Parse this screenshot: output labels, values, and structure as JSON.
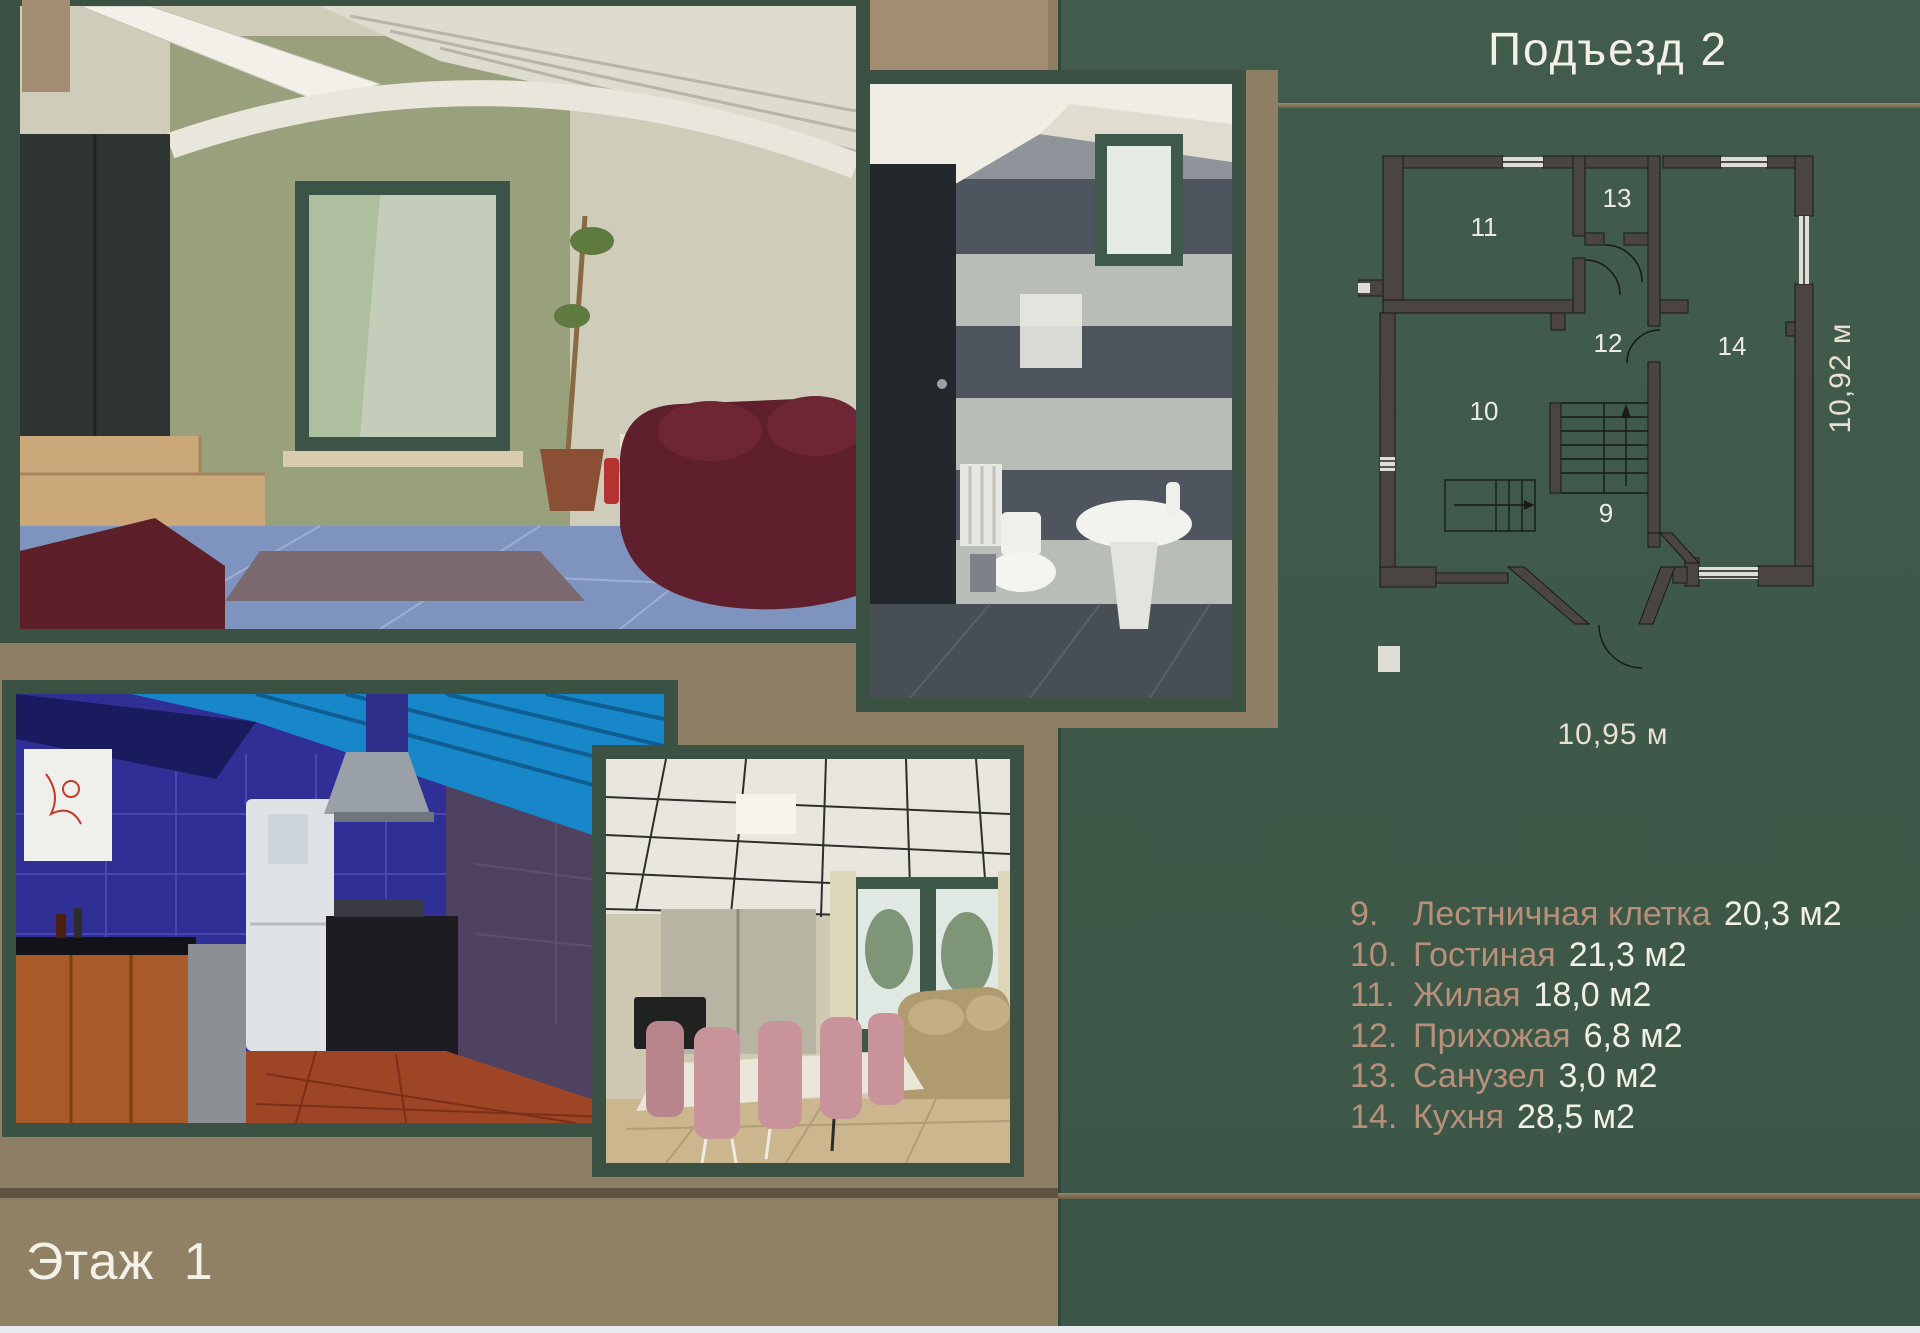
{
  "slide": {
    "title": "Подъезд 2",
    "floor_label": "Этаж 1"
  },
  "floor_plan": {
    "width_label": "10,95 м",
    "height_label": "10,92 м",
    "rooms": [
      {
        "number": "9",
        "x": 248,
        "y": 374
      },
      {
        "number": "10",
        "x": 126,
        "y": 272
      },
      {
        "number": "11",
        "x": 126,
        "y": 88
      },
      {
        "number": "12",
        "x": 250,
        "y": 204
      },
      {
        "number": "13",
        "x": 259,
        "y": 59
      },
      {
        "number": "14",
        "x": 374,
        "y": 207
      }
    ]
  },
  "legend": {
    "items": [
      {
        "number": "9.",
        "name": "Лестничная клетка",
        "area": "20,3 м2"
      },
      {
        "number": "10.",
        "name": "Гостиная",
        "area": "21,3 м2"
      },
      {
        "number": "11.",
        "name": "Жилая",
        "area": "18,0 м2"
      },
      {
        "number": "12.",
        "name": "Прихожая",
        "area": "6,8 м2"
      },
      {
        "number": "13.",
        "name": "Санузел",
        "area": "3,0 м2"
      },
      {
        "number": "14.",
        "name": "Кухня",
        "area": "28,5 м2"
      }
    ]
  },
  "photos": [
    {
      "id": "living-room-photo",
      "description": "гостиная: бордовый кожаный диван, синий пол, окно"
    },
    {
      "id": "bathroom-photo",
      "description": "санузел: серая гранитная плитка, раковина, унитаз"
    },
    {
      "id": "kitchen-photo",
      "description": "кухня: синяя плитка, холодильник, вытяжка, деревянные фасады"
    },
    {
      "id": "dining-room-photo",
      "description": "столовая: розовые стулья, длинный стол, диван, окна"
    }
  ],
  "colors": {
    "background_tan": "#8e7e63",
    "panel_green": "#3f584a",
    "frame_green": "#3b5144",
    "plan_wall": "#4b4542",
    "accent_text": "#b69078",
    "light_text": "#f2efe7",
    "bottom_strip": "#e9ecef"
  }
}
